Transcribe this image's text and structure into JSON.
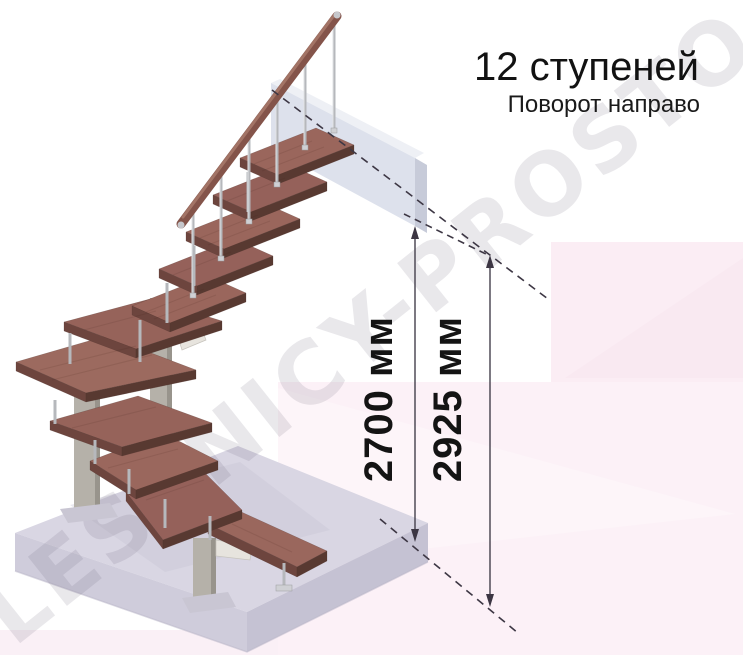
{
  "title": {
    "steps_count": "12 ступеней",
    "turn_direction": "Поворот направо"
  },
  "dimensions": {
    "floor_height": {
      "label": "2700 мм",
      "value_mm": 2700
    },
    "total_height": {
      "label": "2925 мм",
      "value_mm": 2925
    }
  },
  "watermark": {
    "text": "LESTNICY-PROSTO.RU"
  },
  "diagram": {
    "type": "staircase-3d-render",
    "steps": 12,
    "turn": "направо",
    "straight_treads": 6,
    "winder_treads": 5,
    "bottom_step": 1,
    "colors": {
      "wood_tread": "#9a665c",
      "wood_rail": "#84544a",
      "metal_rod": "#b6b8bc",
      "stringer_bracket": "#e7e4de",
      "support_post": "#b5b1a9",
      "floor_slab": "#d9d6e3",
      "landing_panel": "#dde1ec",
      "background_accent": "#fbedf4",
      "dimension_line": "#3c3643",
      "text": "#141414"
    }
  }
}
